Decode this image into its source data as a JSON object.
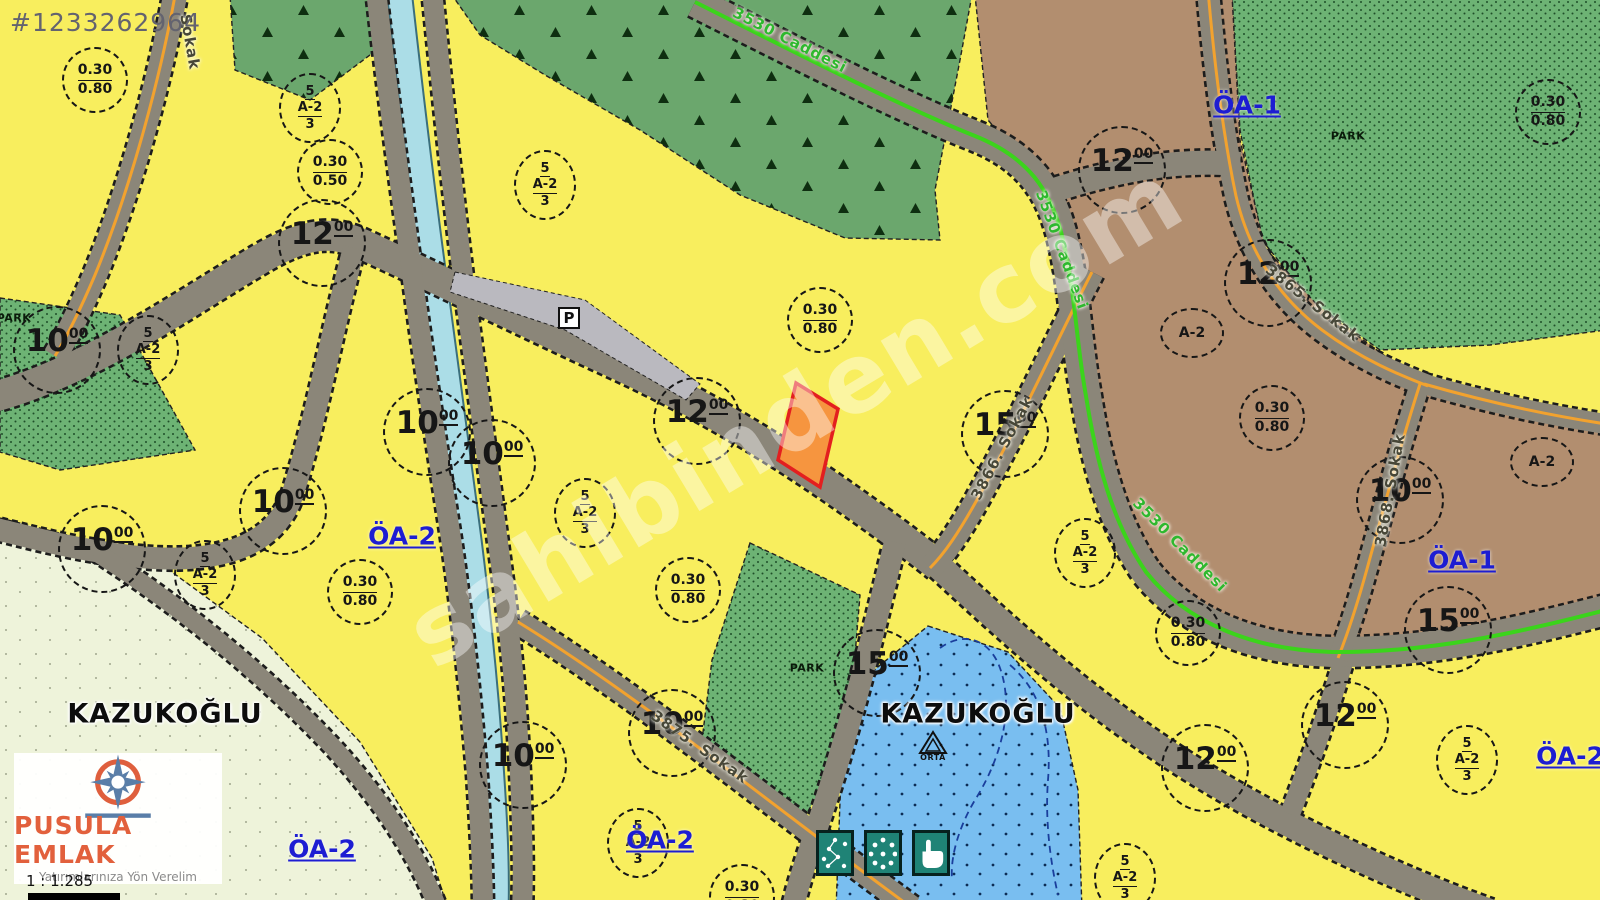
{
  "listing": {
    "id_text": "#1233262964"
  },
  "watermark": {
    "text": "sahibinden.com"
  },
  "branding": {
    "name": "PUSULA EMLAK",
    "tagline": "Yatırımlarınıza Yön Verelim",
    "scale_text": "1 : 1.285"
  },
  "map": {
    "colors": {
      "yellow-zone": "#f8ee5e",
      "tree-zone": "#6ba76d",
      "park-zone": "#6db374",
      "pale-zone": "#eef3da",
      "brown-zone": "#b28e6f",
      "blue-zone": "#79bef0",
      "canal": "#abdde7",
      "road": "#8b8679",
      "road-edge": "#1c1c1c",
      "orange-line": "#f2a22e",
      "green-line": "#3bd41b",
      "parcel-fill": "#f6953f",
      "parcel-border": "#e31f1f",
      "gray-parcel": "#bab9bf",
      "label-blue": "#1d1dd2",
      "street-dark": "#474738",
      "street-green": "#2eb82e",
      "tool-teal": "#1f8376",
      "circle-ink": "#161616"
    },
    "width_circles": [
      {
        "value": "12",
        "sup": "00",
        "x": 322,
        "y": 243
      },
      {
        "value": "10",
        "sup": "00",
        "x": 57,
        "y": 350
      },
      {
        "value": "10",
        "sup": "00",
        "x": 427,
        "y": 432
      },
      {
        "value": "10",
        "sup": "00",
        "x": 492,
        "y": 463
      },
      {
        "value": "10",
        "sup": "00",
        "x": 283,
        "y": 511
      },
      {
        "value": "10",
        "sup": "00",
        "x": 102,
        "y": 549
      },
      {
        "value": "12",
        "sup": "00",
        "x": 697,
        "y": 421
      },
      {
        "value": "15",
        "sup": "00",
        "x": 1005,
        "y": 434
      },
      {
        "value": "12",
        "sup": "00",
        "x": 1122,
        "y": 170
      },
      {
        "value": "12",
        "sup": "00",
        "x": 1268,
        "y": 283
      },
      {
        "value": "10",
        "sup": "00",
        "x": 1400,
        "y": 500
      },
      {
        "value": "15",
        "sup": "00",
        "x": 1448,
        "y": 630
      },
      {
        "value": "12",
        "sup": "00",
        "x": 1345,
        "y": 725
      },
      {
        "value": "12",
        "sup": "00",
        "x": 1205,
        "y": 768
      },
      {
        "value": "15",
        "sup": "00",
        "x": 877,
        "y": 673
      },
      {
        "value": "10",
        "sup": "00",
        "x": 523,
        "y": 765
      },
      {
        "value": "10",
        "sup": "00",
        "x": 672,
        "y": 733
      }
    ],
    "ratio_circles": [
      {
        "top": "0.30",
        "bottom": "0.80",
        "x": 95,
        "y": 80
      },
      {
        "top": "0.30",
        "bottom": "0.50",
        "x": 330,
        "y": 172
      },
      {
        "top": "0.30",
        "bottom": "0.80",
        "x": 820,
        "y": 320
      },
      {
        "top": "0.30",
        "bottom": "0.80",
        "x": 360,
        "y": 592
      },
      {
        "top": "0.30",
        "bottom": "0.80",
        "x": 688,
        "y": 590
      },
      {
        "top": "0.30",
        "bottom": "0.80",
        "x": 1272,
        "y": 418
      },
      {
        "top": "0.30",
        "bottom": "0.80",
        "x": 1188,
        "y": 633
      },
      {
        "top": "0.30",
        "bottom": "0.80",
        "x": 1548,
        "y": 112
      },
      {
        "top": "0.30",
        "bottom": "0.80",
        "x": 742,
        "y": 897
      }
    ],
    "zone_fraction_circles": [
      {
        "top": "5",
        "middle": "A-2",
        "bottom": "3",
        "x": 310,
        "y": 108
      },
      {
        "top": "5",
        "middle": "A-2",
        "bottom": "3",
        "x": 545,
        "y": 185
      },
      {
        "top": "5",
        "middle": "A-2",
        "bottom": "3",
        "x": 148,
        "y": 350
      },
      {
        "top": "5",
        "middle": "A-2",
        "bottom": "3",
        "x": 205,
        "y": 575
      },
      {
        "top": "5",
        "middle": "A-2",
        "bottom": "3",
        "x": 585,
        "y": 513
      },
      {
        "top": "5",
        "middle": "A-2",
        "bottom": "3",
        "x": 1085,
        "y": 553
      },
      {
        "top": "5",
        "middle": "A-2",
        "bottom": "3",
        "x": 638,
        "y": 843
      },
      {
        "top": "5",
        "middle": "A-2",
        "bottom": "3",
        "x": 1125,
        "y": 878
      },
      {
        "top": "5",
        "middle": "A-2",
        "bottom": "3",
        "x": 1467,
        "y": 760
      }
    ],
    "zone_code_circles": [
      {
        "text": "A-2",
        "x": 1192,
        "y": 333
      },
      {
        "text": "A-2",
        "x": 1542,
        "y": 462
      }
    ],
    "district_labels": [
      {
        "text": "KAZUKOĞLU",
        "x": 165,
        "y": 714
      },
      {
        "text": "KAZUKOĞLU",
        "x": 978,
        "y": 714
      }
    ],
    "area_labels": [
      {
        "text": "ÖA-1",
        "x": 1247,
        "y": 105
      },
      {
        "text": "ÖA-1",
        "x": 1462,
        "y": 560
      },
      {
        "text": "ÖA-2",
        "x": 402,
        "y": 536
      },
      {
        "text": "ÖA-2",
        "x": 322,
        "y": 849
      },
      {
        "text": "ÖA-2",
        "x": 660,
        "y": 840
      },
      {
        "text": "ÖA-2",
        "x": 1570,
        "y": 756
      }
    ],
    "park_labels": [
      {
        "text": "PARK",
        "x": 14,
        "y": 318
      },
      {
        "text": "PARK",
        "x": 807,
        "y": 668
      },
      {
        "text": "PARK",
        "x": 1348,
        "y": 136
      }
    ],
    "street_labels": [
      {
        "text": "Sokak",
        "x": 190,
        "y": 42,
        "rot": 80,
        "color": "dark"
      },
      {
        "text": "3530 Caddesi",
        "x": 790,
        "y": 40,
        "rot": 27,
        "color": "green"
      },
      {
        "text": "3530 Caddesi",
        "x": 1062,
        "y": 250,
        "rot": 70,
        "color": "green"
      },
      {
        "text": "3530 Caddesi",
        "x": 1180,
        "y": 545,
        "rot": 45,
        "color": "green"
      },
      {
        "text": "3865. Sokak",
        "x": 1313,
        "y": 303,
        "rot": 38,
        "color": "dark"
      },
      {
        "text": "3866. Sokak",
        "x": 1002,
        "y": 448,
        "rot": -62,
        "color": "dark"
      },
      {
        "text": "3868. Sokak",
        "x": 1390,
        "y": 490,
        "rot": -80,
        "color": "dark"
      },
      {
        "text": "3875. Sokak",
        "x": 700,
        "y": 747,
        "rot": 35,
        "color": "dark"
      }
    ],
    "symbols": {
      "parking_label": "P",
      "school_label": "ORTA"
    },
    "tools": [
      {
        "name": "measure-network-tool"
      },
      {
        "name": "draw-polygon-tool"
      },
      {
        "name": "pan-hand-tool"
      }
    ]
  }
}
